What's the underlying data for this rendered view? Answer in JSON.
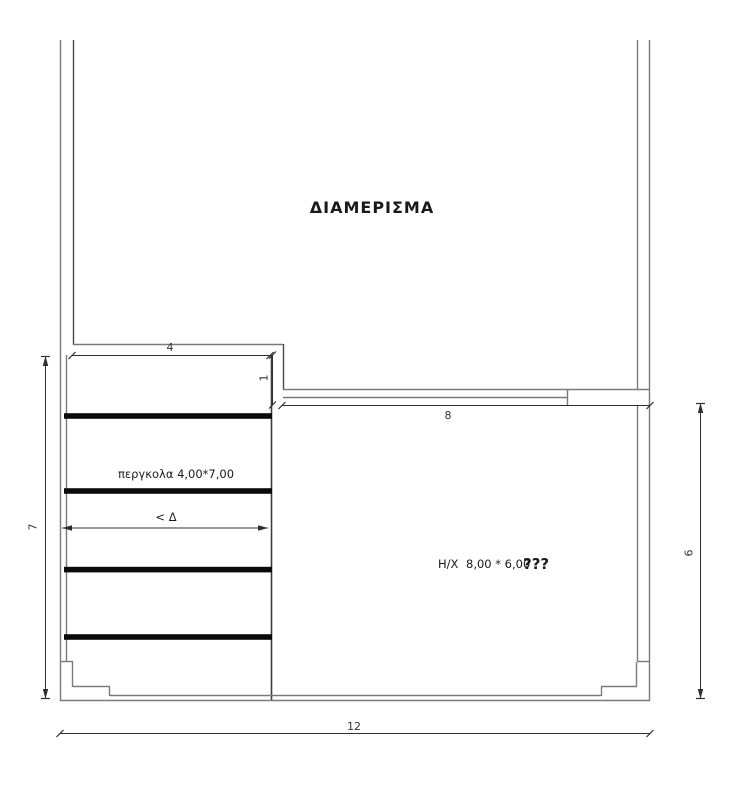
{
  "plan": {
    "apartment": {
      "label": "ΔΙΑΜΕΡΙΣΜΑ"
    },
    "pergola": {
      "label": "περγκολα 4,00*7,00",
      "direction_label": "< Δ"
    },
    "hx": {
      "label": "Η/Χ",
      "size": "8,00 * 6,00",
      "unknown": "???"
    },
    "dimensions": {
      "pergola_width": "4",
      "level_offset": "1",
      "hx_width": "8",
      "pergola_depth": "7",
      "hx_depth": "6",
      "total_width": "12"
    },
    "colors": {
      "wall_line": "#7b7b7b",
      "dark_line": "#3d3d3d",
      "beam": "#0b0b0b",
      "dimension": "#2e2e2e",
      "unknown_color": "#8b1f1f"
    }
  }
}
